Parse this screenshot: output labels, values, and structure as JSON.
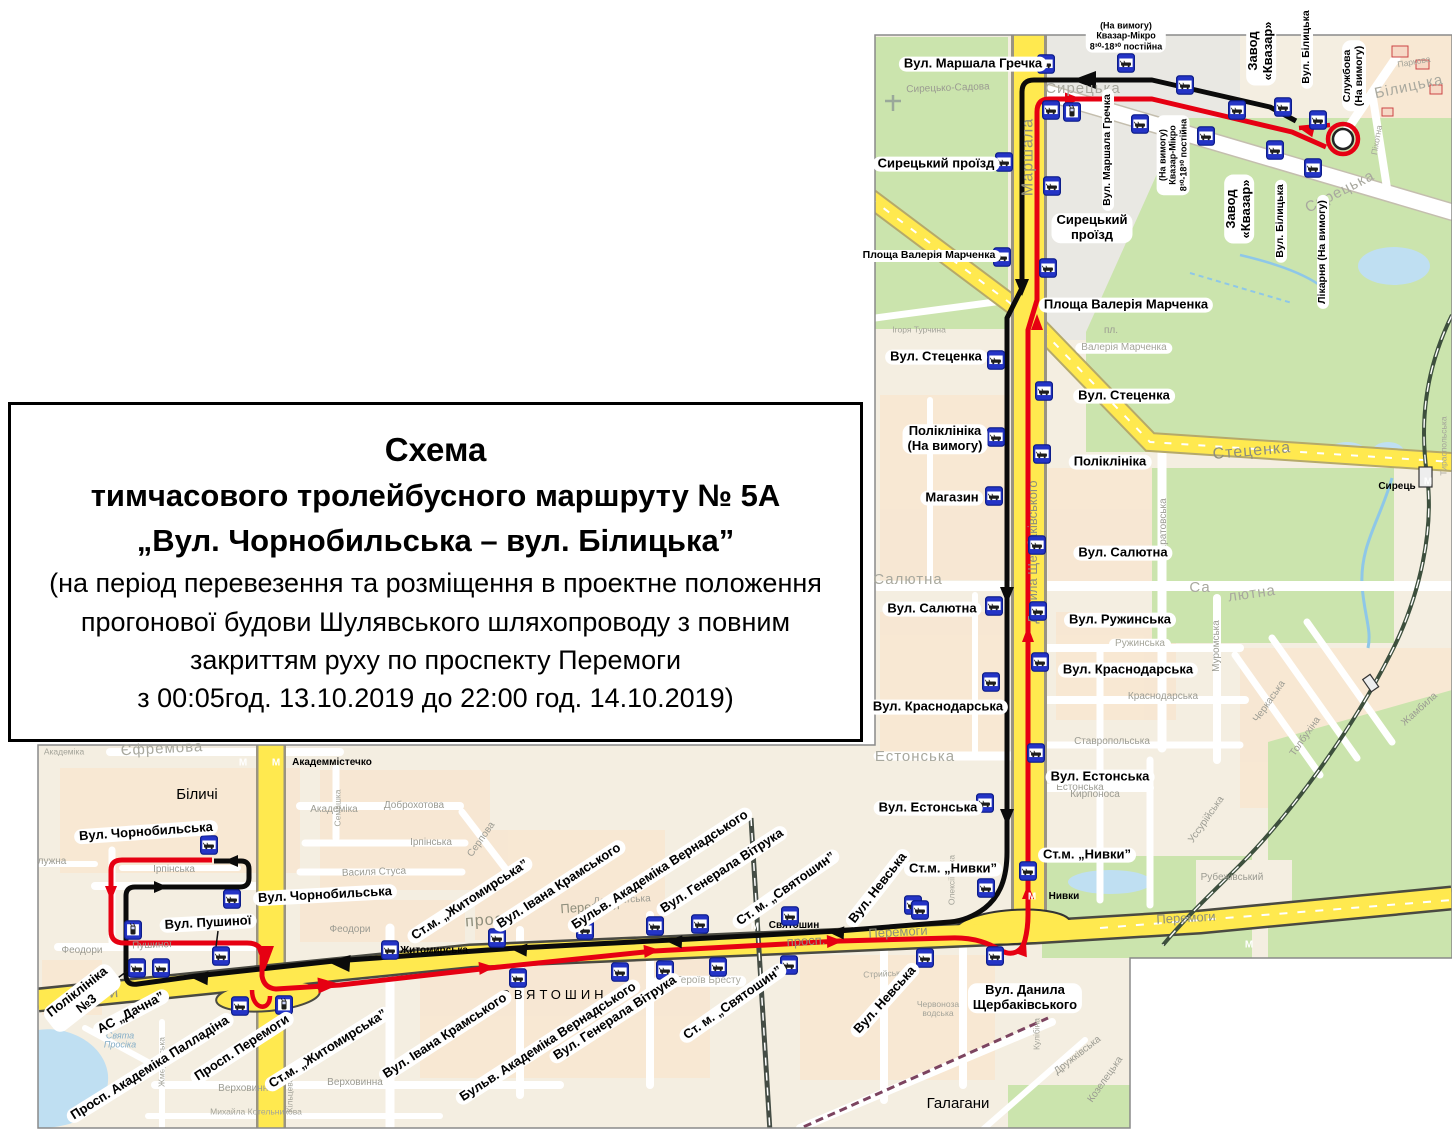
{
  "title": {
    "lines": [
      "Схема",
      "тимчасового тролейбусного маршруту  № 5А",
      "„Вул. Чорнобильська – вул. Білицька”",
      "(на період перевезення та розміщення в проектне положення",
      "прогонової будови Шулявського шляхопроводу з повним",
      "закриттям руху по проспекту Перемоги",
      "з 00:05год. 13.10.2019 до 22:00 год. 14.10.2019)"
    ]
  },
  "route": {
    "number": "5А",
    "from": "Вул. Чорнобильська",
    "to": "вул. Білицька"
  },
  "metro_symbol": "М",
  "colors": {
    "route_red": "#e60012",
    "route_black": "#0b0b0b",
    "road_yellow": "#ffe94f",
    "park_green": "#cbe4ad",
    "water_blue": "#bfdff2",
    "bus_blue": "#2434c6",
    "bus_blue_dark": "#0d1d8a",
    "metro_red": "#d62b1d",
    "district_pink": "#eba7ba",
    "map_bg": "#f4eee1",
    "block_tint": "#f8e7d2",
    "label_border": "#111111"
  },
  "stop_labels": [
    {
      "t": "Вул. Маршала Гречка",
      "x": 973,
      "y": 64,
      "rot": 0
    },
    {
      "t": "(На вимогу)\nКвазар-Мікро\n8³⁰-18³⁰ постійна",
      "x": 1126,
      "y": 36,
      "rot": 0,
      "cls": "xs"
    },
    {
      "t": "Завод\n«Квазар»",
      "x": 1261,
      "y": 51,
      "rot": -90
    },
    {
      "t": "Вул. Білицька",
      "x": 1307,
      "y": 47,
      "rot": -90,
      "cls": "sm"
    },
    {
      "t": "Службова\n(На вимогу)",
      "x": 1354,
      "y": 76,
      "rot": -90,
      "cls": "sm"
    },
    {
      "t": "Сирецький проїзд",
      "x": 936,
      "y": 164,
      "rot": 0
    },
    {
      "t": "Вул. Маршала Гречка",
      "x": 1108,
      "y": 150,
      "rot": -90,
      "cls": "sm"
    },
    {
      "t": "(На вимогу)\nКвазар-Мікро\n8³⁰-18³⁰ постійна",
      "x": 1173,
      "y": 155,
      "rot": -90,
      "cls": "xs"
    },
    {
      "t": "Завод\n«Квазар»",
      "x": 1239,
      "y": 209,
      "rot": -90
    },
    {
      "t": "Вул. Білицька",
      "x": 1281,
      "y": 221,
      "rot": -90,
      "cls": "sm"
    },
    {
      "t": "Лікарня (На вимогу)",
      "x": 1323,
      "y": 252,
      "rot": -90,
      "cls": "sm"
    },
    {
      "t": "Сирецький\nпроїзд",
      "x": 1092,
      "y": 228,
      "rot": 0
    },
    {
      "t": "Площа Валерія Марченка",
      "x": 929,
      "y": 256,
      "rot": 0,
      "cls": "sm"
    },
    {
      "t": "Площа Валерія Марченка",
      "x": 1126,
      "y": 305,
      "rot": 0
    },
    {
      "t": "Вул. Стеценка",
      "x": 936,
      "y": 357,
      "rot": 0
    },
    {
      "t": "Вул. Стеценка",
      "x": 1124,
      "y": 396,
      "rot": 0
    },
    {
      "t": "Поліклініка\n(На вимогу)",
      "x": 945,
      "y": 439,
      "rot": 0
    },
    {
      "t": "Поліклініка",
      "x": 1110,
      "y": 462,
      "rot": 0
    },
    {
      "t": "Магазин",
      "x": 952,
      "y": 498,
      "rot": 0
    },
    {
      "t": "Вул. Салютна",
      "x": 1123,
      "y": 553,
      "rot": 0
    },
    {
      "t": "Вул. Салютна",
      "x": 932,
      "y": 609,
      "rot": 0
    },
    {
      "t": "Вул. Ружинська",
      "x": 1120,
      "y": 620,
      "rot": 0
    },
    {
      "t": "Вул. Краснодарська",
      "x": 1128,
      "y": 670,
      "rot": 0
    },
    {
      "t": "Вул. Краснодарська",
      "x": 938,
      "y": 707,
      "rot": 0
    },
    {
      "t": "Вул. Естонська",
      "x": 1100,
      "y": 777,
      "rot": 0
    },
    {
      "t": "Вул. Естонська",
      "x": 928,
      "y": 808,
      "rot": 0
    },
    {
      "t": "Ст.м. „Нивки”",
      "x": 1087,
      "y": 855,
      "rot": 0
    },
    {
      "t": "Ст.м. „Нивки”",
      "x": 953,
      "y": 869,
      "rot": 0
    },
    {
      "t": "Вул. Невська",
      "x": 878,
      "y": 888,
      "rot": -52
    },
    {
      "t": "Вул. Данила\nЩербаківського",
      "x": 1025,
      "y": 998,
      "rot": 0
    },
    {
      "t": "Вул. Чорнобильська",
      "x": 146,
      "y": 832,
      "rot": -4
    },
    {
      "t": "Вул. Чорнобильська",
      "x": 325,
      "y": 895,
      "rot": -3
    },
    {
      "t": "Вул. Пушиної",
      "x": 208,
      "y": 923,
      "rot": -3
    },
    {
      "t": "Поліклініка\n№3",
      "x": 82,
      "y": 998,
      "rot": -38
    },
    {
      "t": "АС „Дачна”",
      "x": 131,
      "y": 1013,
      "rot": -28
    },
    {
      "t": "Просп. Академіка Палладіна",
      "x": 150,
      "y": 1068,
      "rot": -32
    },
    {
      "t": "Просп. Перемоги",
      "x": 242,
      "y": 1048,
      "rot": -33
    },
    {
      "t": "Ст.м. „Житомирська”",
      "x": 328,
      "y": 1049,
      "rot": -32
    },
    {
      "t": "Вул. Івана Крамського",
      "x": 445,
      "y": 1036,
      "rot": -33
    },
    {
      "t": "Бульв. Академіка Вернадського",
      "x": 548,
      "y": 1042,
      "rot": -33
    },
    {
      "t": "Вул. Генерала Вітрука",
      "x": 615,
      "y": 1018,
      "rot": -33
    },
    {
      "t": "Ст. м. „Святошин”",
      "x": 733,
      "y": 1003,
      "rot": -35
    },
    {
      "t": "Вул. Невська",
      "x": 885,
      "y": 1000,
      "rot": -48
    },
    {
      "t": "Ст.м. „Житомирська”",
      "x": 470,
      "y": 900,
      "rot": -33
    },
    {
      "t": "Вул. Івана Крамського",
      "x": 559,
      "y": 886,
      "rot": -33
    },
    {
      "t": "Бульв. Академіка Вернадського",
      "x": 660,
      "y": 870,
      "rot": -33
    },
    {
      "t": "Вул. Генерала Вітрука",
      "x": 722,
      "y": 871,
      "rot": -33
    },
    {
      "t": "Ст. м. „Святошин”",
      "x": 786,
      "y": 889,
      "rot": -35
    }
  ],
  "map_texts": [
    {
      "t": "Сирецько-Садова",
      "x": 948,
      "y": 89,
      "rot": -2,
      "cls": "st"
    },
    {
      "t": "Сирецька",
      "x": 1083,
      "y": 89,
      "rot": 0,
      "cls": "stlg"
    },
    {
      "t": "Білицька",
      "x": 1409,
      "y": 87,
      "rot": -12,
      "cls": "stlg"
    },
    {
      "t": "Сирецька",
      "x": 1340,
      "y": 192,
      "rot": -27,
      "cls": "stlg"
    },
    {
      "t": "Маршала",
      "x": 1029,
      "y": 157,
      "rot": -90,
      "cls": "roadlg"
    },
    {
      "t": "Данила Щербаківського",
      "x": 1033,
      "y": 552,
      "rot": -90,
      "cls": "road"
    },
    {
      "t": "пл.",
      "x": 1111,
      "y": 331,
      "rot": 0,
      "cls": "st"
    },
    {
      "t": "Валерія Марченка",
      "x": 1124,
      "y": 348,
      "rot": 0,
      "cls": "pill"
    },
    {
      "t": "Ігоря Турчина",
      "x": 919,
      "y": 330,
      "rot": 0,
      "cls": "stsm"
    },
    {
      "t": "Стеценка",
      "x": 1252,
      "y": 452,
      "rot": -5,
      "cls": "roadlg"
    },
    {
      "t": "Салютна",
      "x": 908,
      "y": 580,
      "rot": 0,
      "cls": "stlg"
    },
    {
      "t": "Са",
      "x": 1200,
      "y": 588,
      "rot": 0,
      "cls": "stlg"
    },
    {
      "t": "лютна",
      "x": 1252,
      "y": 594,
      "rot": -8,
      "cls": "stlg"
    },
    {
      "t": "Саратовська",
      "x": 1164,
      "y": 528,
      "rot": -90,
      "cls": "st"
    },
    {
      "t": "Муромська",
      "x": 1217,
      "y": 646,
      "rot": -90,
      "cls": "st"
    },
    {
      "t": "Ружинська",
      "x": 1140,
      "y": 644,
      "rot": 0,
      "cls": "pill"
    },
    {
      "t": "Краснодарська",
      "x": 1163,
      "y": 697,
      "rot": 0,
      "cls": "st"
    },
    {
      "t": "Ставропольська",
      "x": 1112,
      "y": 742,
      "rot": 0,
      "cls": "st"
    },
    {
      "t": "Естонська",
      "x": 915,
      "y": 757,
      "rot": 0,
      "cls": "stlg"
    },
    {
      "t": "Естонська",
      "x": 1080,
      "y": 788,
      "rot": 0,
      "cls": "st"
    },
    {
      "t": "Кирпоноса",
      "x": 1095,
      "y": 795,
      "rot": 0,
      "cls": "st"
    },
    {
      "t": "Рубежівський",
      "x": 1232,
      "y": 878,
      "rot": 0,
      "cls": "st"
    },
    {
      "t": "Черкаська",
      "x": 1270,
      "y": 702,
      "rot": -55,
      "cls": "st"
    },
    {
      "t": "Толбухіна",
      "x": 1306,
      "y": 737,
      "rot": -55,
      "cls": "st"
    },
    {
      "t": "Уссурійська",
      "x": 1207,
      "y": 820,
      "rot": -55,
      "cls": "st"
    },
    {
      "t": "Жамбила",
      "x": 1420,
      "y": 710,
      "rot": -42,
      "cls": "st"
    },
    {
      "t": "Перемоги",
      "x": 1186,
      "y": 918,
      "rot": -3,
      "cls": "road"
    },
    {
      "t": "Сирець",
      "x": 1397,
      "y": 487,
      "rot": 0,
      "cls": "metro"
    },
    {
      "t": "Нивки",
      "x": 1064,
      "y": 897,
      "rot": 0,
      "cls": "metro"
    },
    {
      "t": "Тираспольська",
      "x": 1444,
      "y": 446,
      "rot": -90,
      "cls": "stsm"
    },
    {
      "t": "Піхотна",
      "x": 1377,
      "y": 140,
      "rot": -80,
      "cls": "stsm"
    },
    {
      "t": "Паркова",
      "x": 1414,
      "y": 62,
      "rot": -10,
      "cls": "stsm"
    },
    {
      "t": "Академіка",
      "x": 64,
      "y": 752,
      "rot": 0,
      "cls": "stsm"
    },
    {
      "t": "Єфремова",
      "x": 162,
      "y": 749,
      "rot": -3,
      "cls": "stlg"
    },
    {
      "t": "Академмістечко",
      "x": 332,
      "y": 763,
      "rot": 0,
      "cls": "metro"
    },
    {
      "t": "Біличі",
      "x": 197,
      "y": 795,
      "rot": 0,
      "cls": "district"
    },
    {
      "t": "Академіка",
      "x": 334,
      "y": 810,
      "rot": 0,
      "cls": "st"
    },
    {
      "t": "Доброхотова",
      "x": 414,
      "y": 806,
      "rot": 0,
      "cls": "st"
    },
    {
      "t": "Семашка",
      "x": 338,
      "y": 808,
      "rot": -90,
      "cls": "stsm"
    },
    {
      "t": "Ірпінська",
      "x": 174,
      "y": 870,
      "rot": 0,
      "cls": "st"
    },
    {
      "t": "Ірпінська",
      "x": 431,
      "y": 843,
      "rot": 0,
      "cls": "st"
    },
    {
      "t": "Василя Стуса",
      "x": 374,
      "y": 873,
      "rot": -2,
      "cls": "st"
    },
    {
      "t": "Серпова",
      "x": 482,
      "y": 840,
      "rot": -55,
      "cls": "st"
    },
    {
      "t": "лужна",
      "x": 52,
      "y": 862,
      "rot": 0,
      "cls": "st"
    },
    {
      "t": "Феодори",
      "x": 82,
      "y": 951,
      "rot": 0,
      "cls": "st"
    },
    {
      "t": "Феодори",
      "x": 350,
      "y": 930,
      "rot": 0,
      "cls": "st"
    },
    {
      "t": "Пушиної",
      "x": 152,
      "y": 946,
      "rot": -2,
      "cls": "st"
    },
    {
      "t": "Депутатська",
      "x": 622,
      "y": 901,
      "rot": -3,
      "cls": "st"
    },
    {
      "t": "Житомирська",
      "x": 434,
      "y": 951,
      "rot": 0,
      "cls": "metro"
    },
    {
      "t": "СВЯТОШИН",
      "x": 554,
      "y": 995,
      "rot": 0,
      "cls": "districtlg"
    },
    {
      "t": "пл. Героїв Бресту",
      "x": 700,
      "y": 981,
      "rot": 0,
      "cls": "pill"
    },
    {
      "t": "Верховинна",
      "x": 246,
      "y": 1089,
      "rot": 0,
      "cls": "st"
    },
    {
      "t": "Верховинна",
      "x": 355,
      "y": 1083,
      "rot": 0,
      "cls": "st"
    },
    {
      "t": "Михайла Котельникова",
      "x": 256,
      "y": 1112,
      "rot": 0,
      "cls": "stsm"
    },
    {
      "t": "Свята\nПросіка",
      "x": 120,
      "y": 1041,
      "rot": 0,
      "cls": "water"
    },
    {
      "t": "Святошин",
      "x": 794,
      "y": 926,
      "rot": 0,
      "cls": "metro"
    },
    {
      "t": "просп.",
      "x": 492,
      "y": 921,
      "rot": -4,
      "cls": "roadlg"
    },
    {
      "t": "Перемоги",
      "x": 590,
      "y": 907,
      "rot": -4,
      "cls": "road"
    },
    {
      "t": "просп.",
      "x": 806,
      "y": 941,
      "rot": -3,
      "cls": "road"
    },
    {
      "t": "Перемоги",
      "x": 898,
      "y": 932,
      "rot": -3,
      "cls": "road"
    },
    {
      "t": "моги",
      "x": 100,
      "y": 995,
      "rot": -5,
      "cls": "roadlg"
    },
    {
      "t": "Галагани",
      "x": 958,
      "y": 1104,
      "rot": 0,
      "cls": "district"
    },
    {
      "t": "Дружківська",
      "x": 1078,
      "y": 1056,
      "rot": -38,
      "cls": "st"
    },
    {
      "t": "Козелецька",
      "x": 1106,
      "y": 1080,
      "rot": -55,
      "cls": "st"
    },
    {
      "t": "Кулібіна",
      "x": 1037,
      "y": 1034,
      "rot": -90,
      "cls": "stsm"
    },
    {
      "t": "Стрийська",
      "x": 884,
      "y": 974,
      "rot": -3,
      "cls": "stsm"
    },
    {
      "t": "Червоноза\nводська",
      "x": 938,
      "y": 1009,
      "rot": 0,
      "cls": "stsm"
    },
    {
      "t": "Жмеринська",
      "x": 162,
      "y": 1062,
      "rot": -90,
      "cls": "stsm"
    },
    {
      "t": "Кільцева",
      "x": 290,
      "y": 1095,
      "rot": -90,
      "cls": "stsm"
    },
    {
      "t": "Олексіївська",
      "x": 952,
      "y": 880,
      "rot": -90,
      "cls": "stsm"
    }
  ],
  "bus_icons": [
    {
      "x": 1046,
      "y": 64
    },
    {
      "x": 1126,
      "y": 63
    },
    {
      "x": 1185,
      "y": 85
    },
    {
      "x": 1237,
      "y": 110
    },
    {
      "x": 1283,
      "y": 107
    },
    {
      "x": 1318,
      "y": 120
    },
    {
      "x": 1072,
      "y": 112,
      "v": "t"
    },
    {
      "x": 1140,
      "y": 124
    },
    {
      "x": 1206,
      "y": 136
    },
    {
      "x": 1275,
      "y": 150
    },
    {
      "x": 1313,
      "y": 168
    },
    {
      "x": 1004,
      "y": 162
    },
    {
      "x": 1002,
      "y": 257
    },
    {
      "x": 996,
      "y": 360
    },
    {
      "x": 996,
      "y": 437
    },
    {
      "x": 994,
      "y": 496
    },
    {
      "x": 994,
      "y": 606
    },
    {
      "x": 991,
      "y": 682
    },
    {
      "x": 985,
      "y": 803
    },
    {
      "x": 986,
      "y": 888
    },
    {
      "x": 913,
      "y": 905
    },
    {
      "x": 1051,
      "y": 110
    },
    {
      "x": 1052,
      "y": 186
    },
    {
      "x": 1048,
      "y": 268
    },
    {
      "x": 1044,
      "y": 391
    },
    {
      "x": 1042,
      "y": 454
    },
    {
      "x": 1037,
      "y": 545
    },
    {
      "x": 1038,
      "y": 611
    },
    {
      "x": 1040,
      "y": 662
    },
    {
      "x": 1036,
      "y": 753
    },
    {
      "x": 1028,
      "y": 871
    },
    {
      "x": 209,
      "y": 845
    },
    {
      "x": 232,
      "y": 899
    },
    {
      "x": 133,
      "y": 930,
      "v": "t"
    },
    {
      "x": 221,
      "y": 956
    },
    {
      "x": 137,
      "y": 968
    },
    {
      "x": 161,
      "y": 968
    },
    {
      "x": 240,
      "y": 1006
    },
    {
      "x": 284,
      "y": 1005,
      "v": "t"
    },
    {
      "x": 390,
      "y": 950
    },
    {
      "x": 497,
      "y": 938
    },
    {
      "x": 518,
      "y": 978
    },
    {
      "x": 585,
      "y": 930
    },
    {
      "x": 620,
      "y": 972
    },
    {
      "x": 655,
      "y": 926
    },
    {
      "x": 665,
      "y": 970
    },
    {
      "x": 700,
      "y": 924
    },
    {
      "x": 718,
      "y": 967
    },
    {
      "x": 790,
      "y": 916
    },
    {
      "x": 789,
      "y": 965
    },
    {
      "x": 920,
      "y": 910
    },
    {
      "x": 925,
      "y": 958
    },
    {
      "x": 995,
      "y": 956
    }
  ],
  "metro_icons": [
    {
      "x": 243,
      "y": 763
    },
    {
      "x": 276,
      "y": 763
    },
    {
      "x": 1032,
      "y": 897
    },
    {
      "x": 1428,
      "y": 482
    },
    {
      "x": 755,
      "y": 927
    },
    {
      "x": 1249,
      "y": 945
    }
  ]
}
